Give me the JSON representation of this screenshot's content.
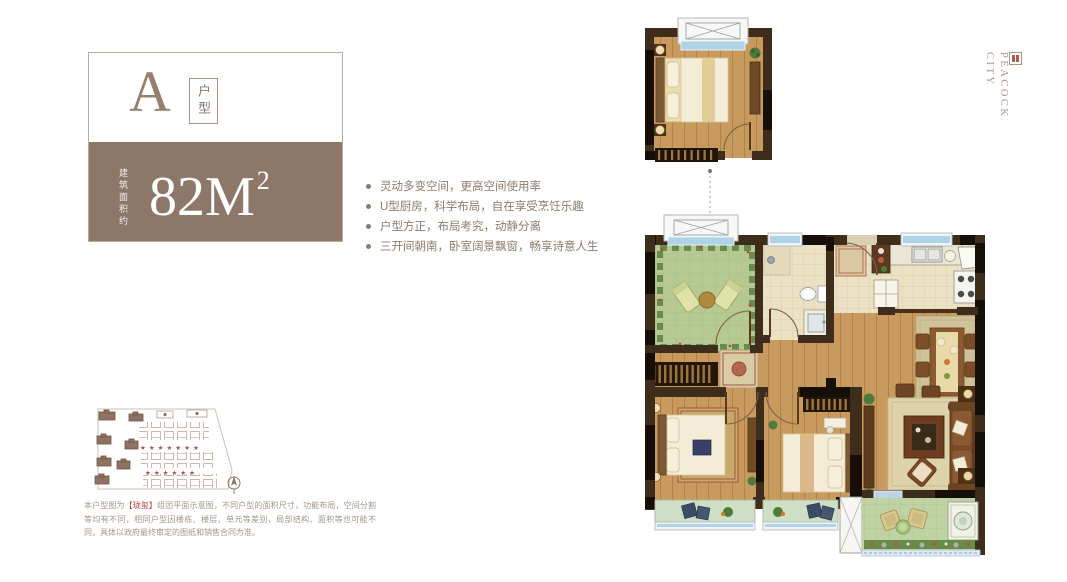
{
  "brand": {
    "line1": "PEACOCK",
    "line2": "CITY"
  },
  "type_card": {
    "letter": "A",
    "type_label": "户型",
    "area_prefix": "建筑面积约",
    "area_value": "82M",
    "area_sup": "2",
    "band_color": "#8d7769"
  },
  "features": {
    "items": [
      "灵动多变空间，更高空间使用率",
      "U型厨房，科学布局，自在享受烹饪乐趣",
      "户型方正，布局考究，动静分离",
      "三开间朝南，卧室阔景飘窗，畅享诗意人生"
    ]
  },
  "disclaimer": {
    "prefix": "本户型图为",
    "highlight": "【珑玺】",
    "suffix": "组团平面示意图，不同户型的面积尺寸，功能布局，空间分割等均有不同，相同户型因楼栋、楼层、单元等差别，局部结构、面积等也可能不同，具体以政府最终审定的图纸和销售合同为准。"
  },
  "colors": {
    "accent_brown": "#8d7769",
    "text_brown": "#8d7b6c",
    "disclaimer_red": "#b5433a",
    "wall_dark": "#3f2d1c",
    "wood_floor": "#c89a5e",
    "garden_green": "#b7c992",
    "window_glass": "#aed2e6"
  }
}
